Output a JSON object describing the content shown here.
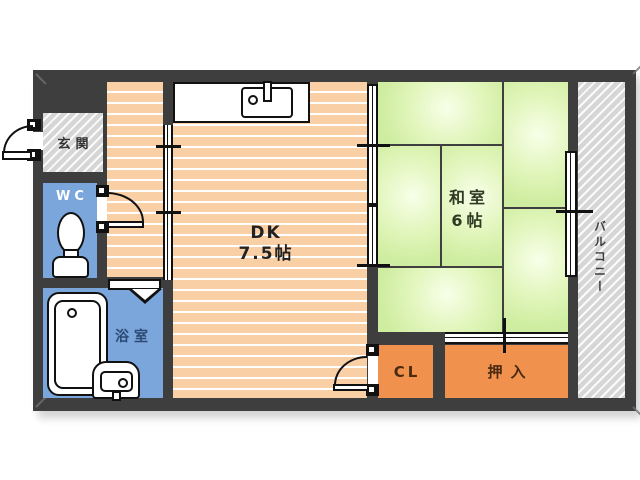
{
  "floorplan": {
    "type": "japanese-apartment-floor-plan",
    "rooms": {
      "genkan": {
        "label": "玄関"
      },
      "wc": {
        "label": "WC"
      },
      "bath": {
        "label": "浴室"
      },
      "dk": {
        "name": "DK",
        "size": "7.5帖"
      },
      "washitsu": {
        "name": "和室",
        "size": "6帖",
        "tatami_count": 6
      },
      "cl": {
        "label": "CL"
      },
      "oshiire": {
        "label": "押入"
      },
      "balcony": {
        "label": "バルコニー"
      }
    },
    "fixtures": [
      "kitchen-counter-with-sink",
      "toilet",
      "bathtub",
      "washbasin"
    ],
    "doors": [
      "entrance-swing-door",
      "wc-swing-door",
      "bathroom-folding-door",
      "closet-swing-door",
      "hallway-sliding-door",
      "dk-washitsu-sliding-door",
      "balcony-sliding-window",
      "oshiire-fusuma"
    ],
    "colors": {
      "wall": "#3e3e3e",
      "dk_floor": "#f9cfa5",
      "tatami_green": "#d9f0a8",
      "wet_area_blue": "#7aa6dc",
      "storage_orange": "#f0914e",
      "hatch_gray": "#d6d6d6",
      "line_black": "#111111"
    }
  }
}
